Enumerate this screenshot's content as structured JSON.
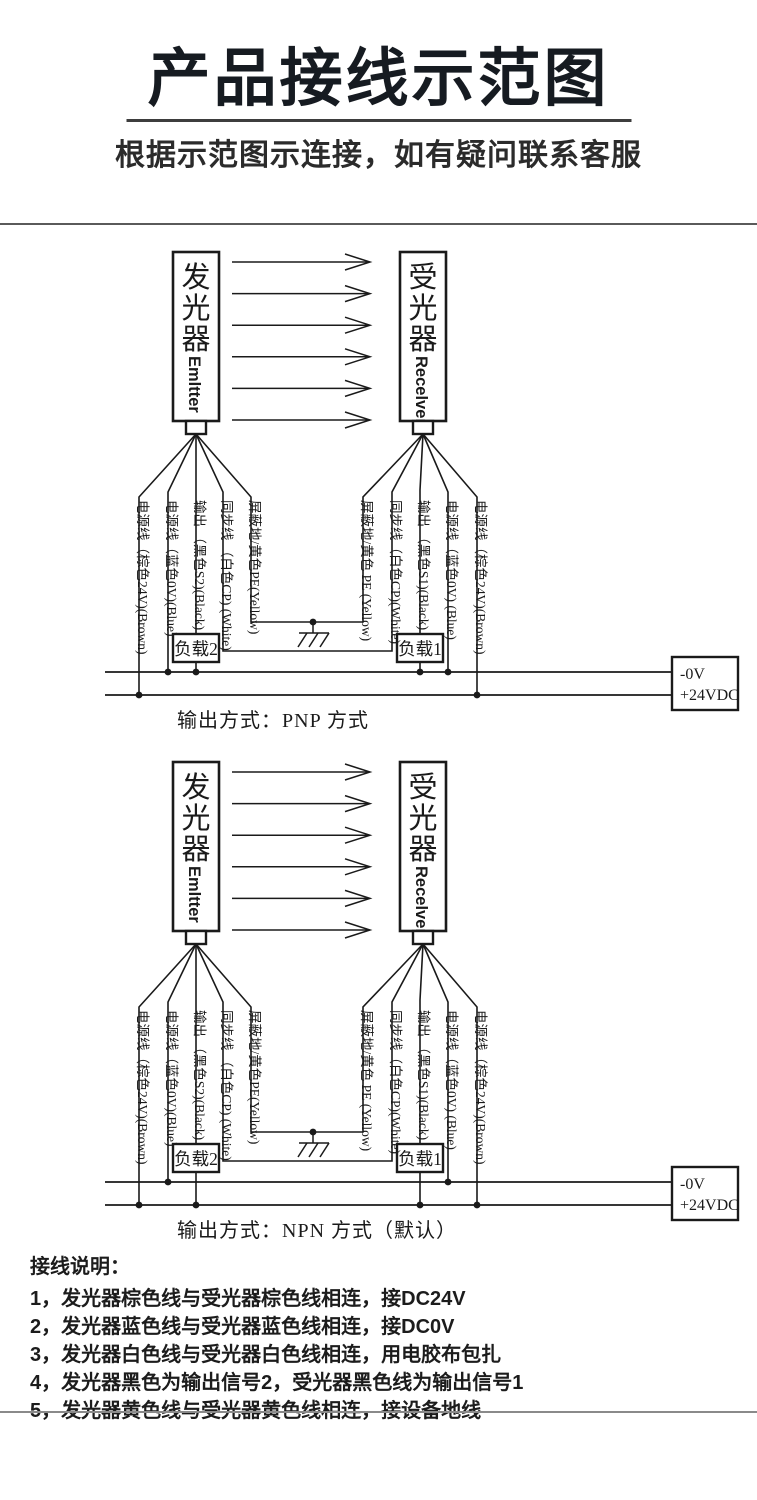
{
  "header": {
    "title": "产品接线示范图",
    "subtitle": "根据示范图示连接，如有疑问联系客服"
  },
  "device": {
    "emitter_cn": "发光器",
    "emitter_en": "Emltter",
    "receiver_cn": "受光器",
    "receiver_en": "Recelver"
  },
  "wires": {
    "emitter": [
      {
        "label": "电源线（棕色24V)(Brown)",
        "color_name": "brown"
      },
      {
        "label": "电源线（蓝色0V)(Blue)",
        "color_name": "blue"
      },
      {
        "label": "输出 （黑色S2)(Black)",
        "color_name": "black"
      },
      {
        "label": "同步线 （白色CP) (White)",
        "color_name": "white"
      },
      {
        "label": "屏蔽地/黄色PE(Yellow)",
        "color_name": "yellow"
      }
    ],
    "receiver": [
      {
        "label": "屏蔽地/黄色 PE (Yellow)",
        "color_name": "yellow"
      },
      {
        "label": "同步线（白色CP)(White)",
        "color_name": "white"
      },
      {
        "label": "输出 （黑色S1)(Black)",
        "color_name": "black"
      },
      {
        "label": "电源线（蓝色0V) (Blue)",
        "color_name": "blue"
      },
      {
        "label": "电源线（棕色24V)(Brown)",
        "color_name": "brown"
      }
    ]
  },
  "loads": {
    "load2": "负载2",
    "load1": "负载1"
  },
  "power_box": {
    "line1": "-0V",
    "line2": "+24VDC"
  },
  "diagrams": [
    {
      "id": "pnp",
      "mode": "PNP",
      "caption": "输出方式：PNP 方式"
    },
    {
      "id": "npn",
      "mode": "NPN",
      "caption": "输出方式：NPN 方式（默认）"
    }
  ],
  "notes": {
    "heading": "接线说明：",
    "items": [
      "1，发光器棕色线与受光器棕色线相连，接DC24V",
      "2，发光器蓝色线与受光器蓝色线相连，接DC0V",
      "3，发光器白色线与受光器白色线相连，用电胶布包扎",
      "4，发光器黑色为输出信号2，受光器黑色线为输出信号1",
      "5，发光器黄色线与受光器黄色线相连，接设备地线"
    ]
  },
  "colors": {
    "ink": "#1a1a1a",
    "title_ink": "#161b21"
  }
}
